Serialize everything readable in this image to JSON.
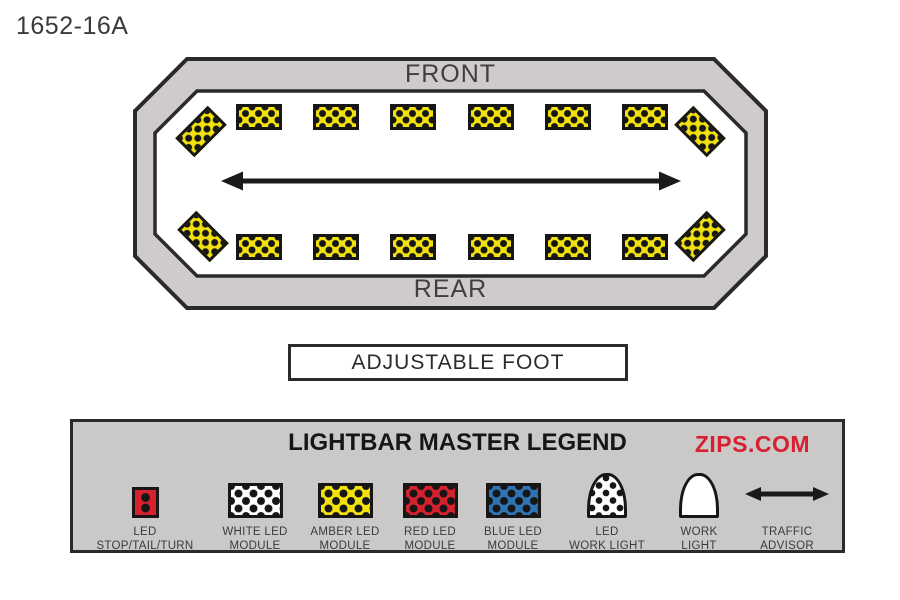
{
  "page": {
    "title": "1652-16A",
    "background": "#FFFFFF"
  },
  "lightbar": {
    "front_label": "FRONT",
    "rear_label": "REAR",
    "frame_color": "#CECBCA",
    "outline_color": "#2A2A2A",
    "interior_color": "#FFFFFF",
    "module_color": "#F2E10D",
    "module_dot_color": "#161616",
    "front_row_module_count": 6,
    "rear_row_module_count": 6,
    "corner_module_count": 4
  },
  "adjustable_foot": {
    "label": "ADJUSTABLE FOOT"
  },
  "legend": {
    "title": "LIGHTBAR MASTER LEGEND",
    "brand": "ZIPS.COM",
    "brand_color": "#D6202F",
    "background": "#CBC8C8",
    "items": [
      {
        "icon": "led-stop-tail-turn-icon",
        "color": "#D6212E",
        "label_line1": "LED",
        "label_line2": "STOP/TAIL/TURN"
      },
      {
        "icon": "white-led-module-icon",
        "color": "#FFFFFF",
        "label_line1": "WHITE LED",
        "label_line2": "MODULE"
      },
      {
        "icon": "amber-led-module-icon",
        "color": "#F2E10D",
        "label_line1": "AMBER LED",
        "label_line2": "MODULE"
      },
      {
        "icon": "red-led-module-icon",
        "color": "#D6212E",
        "label_line1": "RED LED",
        "label_line2": "MODULE"
      },
      {
        "icon": "blue-led-module-icon",
        "color": "#2E74B5",
        "label_line1": "BLUE LED",
        "label_line2": "MODULE"
      },
      {
        "icon": "led-work-light-icon",
        "color": "#FFFFFF",
        "label_line1": "LED",
        "label_line2": "WORK LIGHT"
      },
      {
        "icon": "work-light-icon",
        "color": "#FFFFFF",
        "label_line1": "WORK",
        "label_line2": "LIGHT"
      },
      {
        "icon": "traffic-advisor-icon",
        "color": "#1A1A1A",
        "label_line1": "TRAFFIC",
        "label_line2": "ADVISOR"
      }
    ]
  }
}
